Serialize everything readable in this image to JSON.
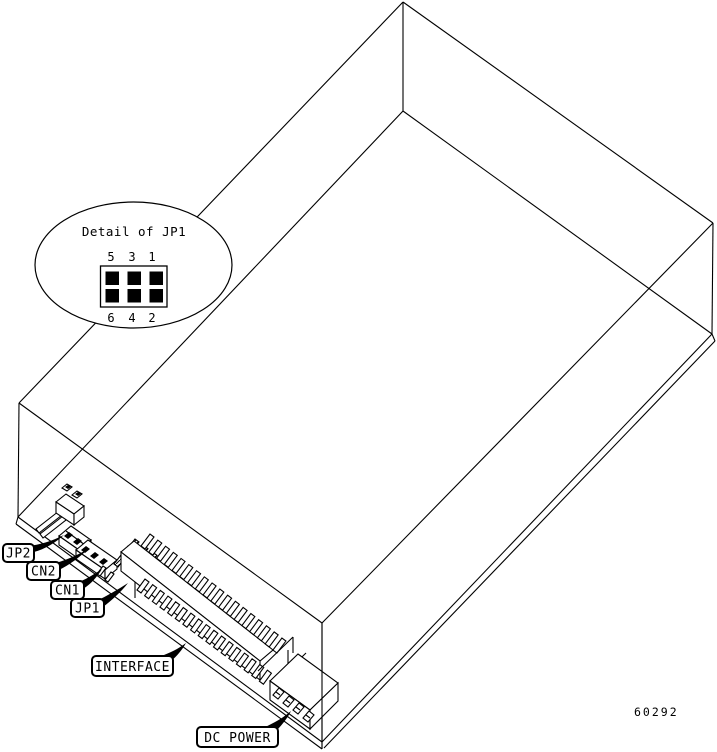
{
  "callout": {
    "title": "Detail of JP1",
    "pins_top": [
      "5",
      "3",
      "1"
    ],
    "pins_bottom": [
      "6",
      "4",
      "2"
    ]
  },
  "labels": {
    "jp2": "JP2",
    "cn2": "CN2",
    "cn1": "CN1",
    "jp1": "JP1",
    "interface": "INTERFACE",
    "dc_power": "DC POWER"
  },
  "figure_number": "60292",
  "colors": {
    "line": "#000000",
    "background": "#ffffff"
  }
}
